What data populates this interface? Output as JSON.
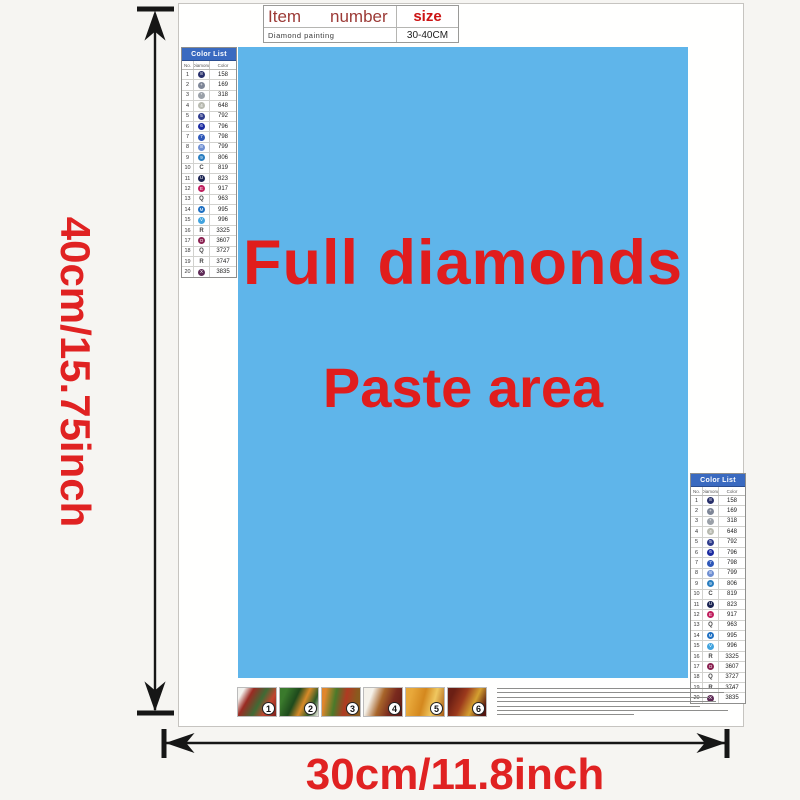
{
  "item_table": {
    "header": {
      "item": "Item",
      "number": "number",
      "size": "size"
    },
    "row": {
      "name": "Diamond painting",
      "size_value": "30-40CM"
    }
  },
  "paste_area": {
    "line1": "Full diamonds",
    "line2": "Paste area",
    "bg": "#5fb5ea",
    "text_color": "#e01d1d"
  },
  "dimensions": {
    "height_label": "40cm/15.75inch",
    "width_label": "30cm/11.8inch",
    "label_color": "#e02222"
  },
  "color_list": {
    "title": "Color List",
    "columns": [
      "No.",
      "Diamond",
      "Color"
    ],
    "rows": [
      {
        "no": "1",
        "code": "158",
        "type": "circle",
        "color": "#28306b",
        "symbol": "8"
      },
      {
        "no": "2",
        "code": "169",
        "type": "circle",
        "color": "#7e8697",
        "symbol": "+"
      },
      {
        "no": "3",
        "code": "318",
        "type": "circle",
        "color": "#9aa0a8",
        "symbol": "*"
      },
      {
        "no": "4",
        "code": "648",
        "type": "circle",
        "color": "#b8bab0",
        "symbol": "4"
      },
      {
        "no": "5",
        "code": "792",
        "type": "circle",
        "color": "#2f3c8c",
        "symbol": "5"
      },
      {
        "no": "6",
        "code": "796",
        "type": "circle",
        "color": "#1b2aa0",
        "symbol": "6"
      },
      {
        "no": "7",
        "code": "798",
        "type": "circle",
        "color": "#2e57b8",
        "symbol": "7"
      },
      {
        "no": "8",
        "code": "799",
        "type": "circle",
        "color": "#6f8fd2",
        "symbol": "8"
      },
      {
        "no": "9",
        "code": "806",
        "type": "circle",
        "color": "#2a7ec0",
        "symbol": "9"
      },
      {
        "no": "10",
        "code": "819",
        "type": "letter",
        "letter": "C"
      },
      {
        "no": "11",
        "code": "823",
        "type": "circle",
        "color": "#1b2452",
        "symbol": "U"
      },
      {
        "no": "12",
        "code": "917",
        "type": "circle",
        "color": "#c01f5e",
        "symbol": "E"
      },
      {
        "no": "13",
        "code": "963",
        "type": "letter",
        "letter": "Q"
      },
      {
        "no": "14",
        "code": "995",
        "type": "circle",
        "color": "#1f70c2",
        "symbol": "M"
      },
      {
        "no": "15",
        "code": "996",
        "type": "circle",
        "color": "#41a3de",
        "symbol": "V"
      },
      {
        "no": "16",
        "code": "3325",
        "type": "letter",
        "letter": "R"
      },
      {
        "no": "17",
        "code": "3607",
        "type": "circle",
        "color": "#8a2150",
        "symbol": "O"
      },
      {
        "no": "18",
        "code": "3727",
        "type": "letter",
        "letter": "Q"
      },
      {
        "no": "19",
        "code": "3747",
        "type": "letter",
        "letter": "R"
      },
      {
        "no": "20",
        "code": "3835",
        "type": "circle",
        "color": "#5e2a56",
        "symbol": "X"
      }
    ]
  },
  "steps": {
    "labels": [
      "1",
      "2",
      "3",
      "4",
      "5",
      "6"
    ]
  }
}
